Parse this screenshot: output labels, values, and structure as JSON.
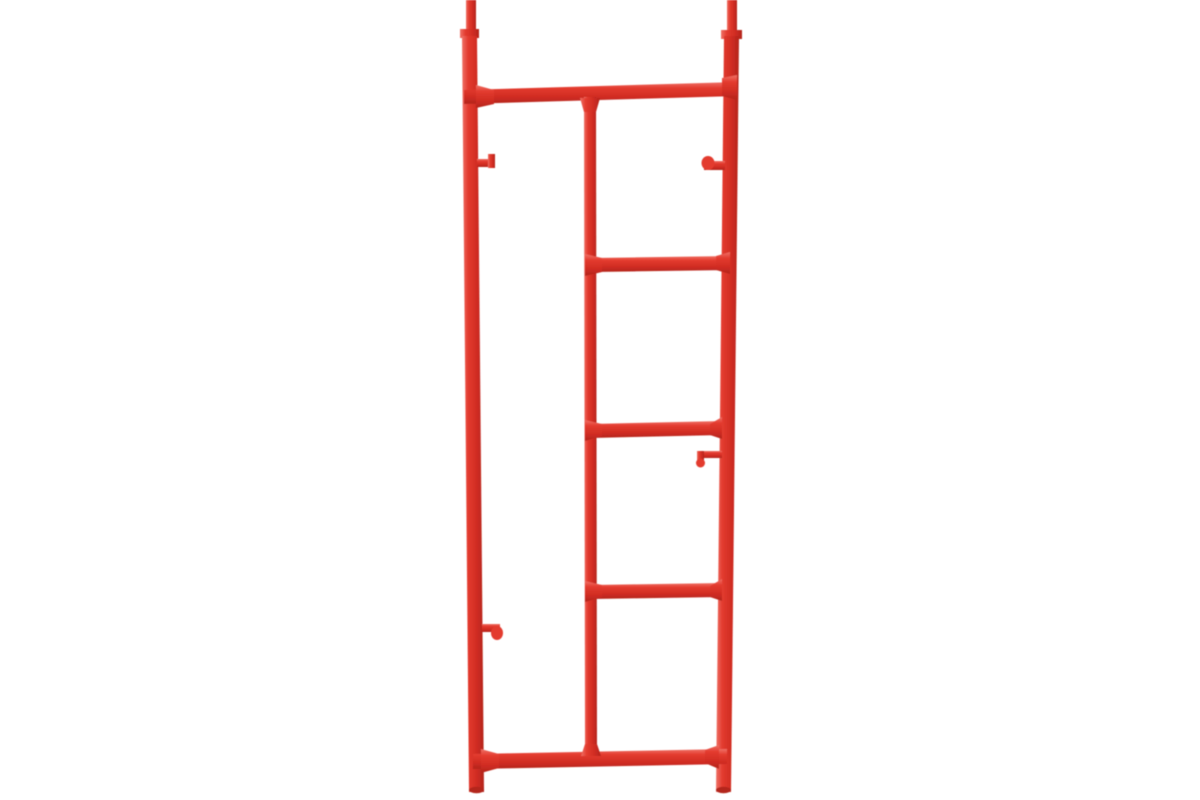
{
  "scene": {
    "type": "product-photo",
    "subject": "Red steel scaffolding ladder end frame on white background",
    "background_color": "#ffffff"
  },
  "palette": {
    "tube_light": "#ef7166",
    "tube_base": "#e33b2f",
    "tube_shade": "#d02c22",
    "tube_dark": "#b3251d"
  },
  "frame": {
    "viewbox": "0 0 1200 800",
    "parts": [
      {
        "name": "left-spigot",
        "kind": "polygon",
        "orient": "v",
        "points": "466,0 476,0 476,31 466,31"
      },
      {
        "name": "left-spigot-collar",
        "kind": "polygon",
        "orient": "v",
        "points": "460,29 479,29 479,38 460,38"
      },
      {
        "name": "left-post",
        "kind": "polygon",
        "orient": "v",
        "points": "462,36 477,36 484,792 469,792"
      },
      {
        "name": "right-spigot",
        "kind": "polygon",
        "orient": "v",
        "points": "727,0 737,0 737,32 727,32"
      },
      {
        "name": "right-spigot-collar",
        "kind": "polygon",
        "orient": "v",
        "points": "721,30 742,30 742,39 721,39"
      },
      {
        "name": "right-post",
        "kind": "polygon",
        "orient": "v",
        "points": "724,36 739,36 731,792 716,792"
      },
      {
        "name": "top-bar",
        "kind": "polygon",
        "orient": "h",
        "points": "464,90 737,82 737,96 464,104"
      },
      {
        "name": "middle-post",
        "kind": "polygon",
        "orient": "v",
        "points": "584,97 596,97 597,757 585,757"
      },
      {
        "name": "rung-1",
        "kind": "polygon",
        "orient": "h",
        "points": "591,258 730,256 730,270 591,272"
      },
      {
        "name": "rung-2",
        "kind": "polygon",
        "orient": "h",
        "points": "591,424 722,421 722,435 591,438"
      },
      {
        "name": "rung-3",
        "kind": "polygon",
        "orient": "h",
        "points": "591,585 722,583 722,597 591,599"
      },
      {
        "name": "bottom-bar",
        "kind": "polygon",
        "orient": "h",
        "points": "473,754 727,749 727,764 473,769"
      },
      {
        "name": "weld-top-bar-left",
        "kind": "polygon",
        "orient": "h",
        "points": "476,85 494,90 494,104 476,108"
      },
      {
        "name": "weld-top-bar-right",
        "kind": "polygon",
        "orient": "h",
        "points": "722,78 737,75 737,100 722,96"
      },
      {
        "name": "weld-middle-post-top",
        "kind": "polygon",
        "orient": "v",
        "points": "580,98 600,98 596,112 584,112"
      },
      {
        "name": "weld-middle-post-bottom",
        "kind": "polygon",
        "orient": "v",
        "points": "585,744 597,744 601,756 581,756"
      },
      {
        "name": "weld-rung-1-left",
        "kind": "polygon",
        "orient": "h",
        "points": "585,254 602,258 602,272 585,276"
      },
      {
        "name": "weld-rung-1-right",
        "kind": "polygon",
        "orient": "h",
        "points": "716,256 730,252 730,274 716,270"
      },
      {
        "name": "weld-rung-2-left",
        "kind": "polygon",
        "orient": "h",
        "points": "585,420 602,424 602,436 585,441"
      },
      {
        "name": "weld-rung-2-right",
        "kind": "polygon",
        "orient": "h",
        "points": "710,424 722,417 722,439 710,435"
      },
      {
        "name": "weld-rung-3-left",
        "kind": "polygon",
        "orient": "h",
        "points": "585,581 602,585 602,597 585,602"
      },
      {
        "name": "weld-rung-3-right",
        "kind": "polygon",
        "orient": "h",
        "points": "710,586 722,579 722,601 710,597"
      },
      {
        "name": "weld-bottom-bar-left",
        "kind": "polygon",
        "orient": "h",
        "points": "481,749 499,754 499,768 481,773"
      },
      {
        "name": "weld-bottom-bar-right",
        "kind": "polygon",
        "orient": "h",
        "points": "705,750 719,745 719,769 705,763"
      },
      {
        "name": "upper-left-pin",
        "kind": "polygon",
        "orient": "h",
        "points": "477,159 494,159 494,167 477,167"
      },
      {
        "name": "upper-left-pin-cap",
        "kind": "polygon",
        "orient": "v",
        "points": "488,154 495,154 495,168 488,168"
      },
      {
        "name": "upper-right-pin",
        "kind": "polygon",
        "orient": "h",
        "points": "704,161 725,161 725,170 704,170"
      },
      {
        "name": "upper-right-pin-knob",
        "kind": "ellipse",
        "cx": 708,
        "cy": 163,
        "rx": 6.5,
        "ry": 7,
        "fill": "base"
      },
      {
        "name": "mid-right-pin",
        "kind": "polygon",
        "orient": "h",
        "points": "699,451 722,451 722,458 699,458"
      },
      {
        "name": "mid-right-pin-drop",
        "kind": "polygon",
        "orient": "v",
        "points": "697,451 704,451 704,464 697,464"
      },
      {
        "name": "mid-right-pin-knob",
        "kind": "ellipse",
        "cx": 700.5,
        "cy": 463,
        "rx": 4.5,
        "ry": 4.5,
        "fill": "base"
      },
      {
        "name": "lower-left-pin",
        "kind": "polygon",
        "orient": "h",
        "points": "482,624 500,624 500,632 482,632"
      },
      {
        "name": "lower-left-pin-knob",
        "kind": "ellipse",
        "cx": 497,
        "cy": 633,
        "rx": 6,
        "ry": 7,
        "fill": "base"
      },
      {
        "name": "left-post-bottom-cap",
        "kind": "ellipse",
        "cx": 476.5,
        "cy": 790,
        "rx": 7.5,
        "ry": 3.2,
        "fill": "dark"
      },
      {
        "name": "right-post-bottom-cap",
        "kind": "ellipse",
        "cx": 723.5,
        "cy": 790,
        "rx": 7.5,
        "ry": 3.2,
        "fill": "dark"
      }
    ]
  }
}
